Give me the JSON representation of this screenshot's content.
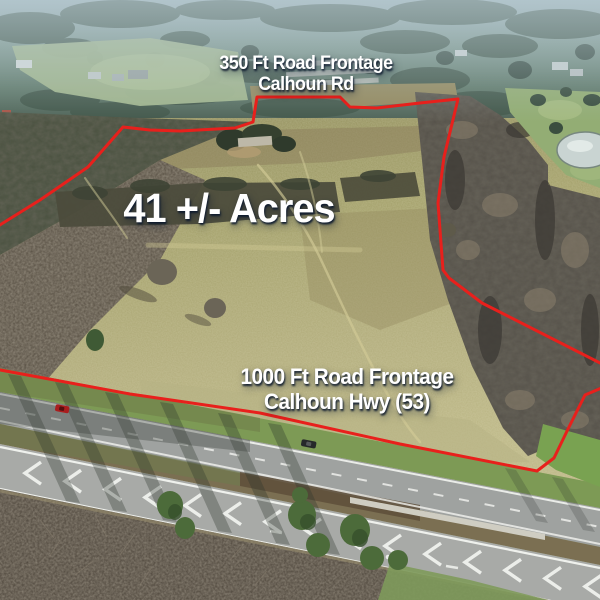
{
  "labels": {
    "top_frontage": {
      "line1": "350 Ft Road Frontage",
      "line2": "Calhoun Rd"
    },
    "acreage": "41 +/- Acres",
    "bottom_frontage": {
      "line1": "1000 Ft Road Frontage",
      "line2": "Calhoun Hwy (53)"
    }
  },
  "colors": {
    "boundary": "#e8201c",
    "label_text": "#ffffff",
    "label_shadow": "rgba(14,26,46,0.9)",
    "road_marking": "#f2f4f0"
  }
}
